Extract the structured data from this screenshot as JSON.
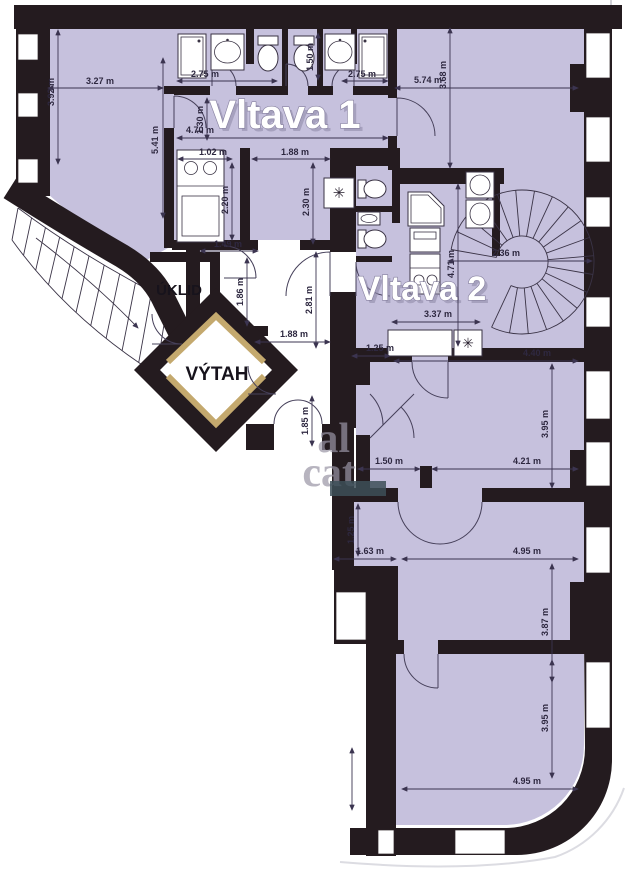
{
  "plan": {
    "type": "apartment-floor-plan",
    "units": "m",
    "rooms": {
      "vltava1": "Vltava 1",
      "vltava2": "Vltava 2",
      "uklid": "ÚKLID",
      "vytah": "VÝTAH"
    },
    "watermark": {
      "fragment1": "al",
      "fragment2": "cat"
    },
    "colors": {
      "wall": "#241b1f",
      "apartment_fill": "#c6c1dd",
      "common_fill": "#ffffff",
      "elevator_frame": "#c4a96e",
      "dimension_text": "#2e2840"
    },
    "fixtures": [
      "shower",
      "washbasin",
      "toilet",
      "toilet",
      "washbasin",
      "shower",
      "kitchen-sink-unit",
      "washing-machine",
      "toilet",
      "washbasin",
      "toilet",
      "corner-shower",
      "washbasin",
      "bathtub",
      "refrigerator",
      "stove",
      "kitchen-counter",
      "dishwasher",
      "spiral-staircase",
      "main-staircase",
      "elevator"
    ],
    "dimensions": [
      {
        "label": "3.92 m",
        "tx": 54,
        "ty": 92,
        "rot": -90,
        "arrow": [
          58,
          30,
          58,
          164
        ]
      },
      {
        "label": "3.27 m",
        "tx": 100,
        "ty": 84,
        "rot": 0,
        "arrow": [
          48,
          88,
          163,
          88
        ]
      },
      {
        "label": "5.41 m",
        "tx": 158,
        "ty": 140,
        "rot": -90,
        "arrow": [
          163,
          58,
          163,
          218
        ]
      },
      {
        "label": "2.75 m",
        "tx": 205,
        "ty": 77,
        "rot": 0,
        "arrow": [
          177,
          81,
          277,
          81
        ]
      },
      {
        "label": "1.50 m",
        "tx": 313,
        "ty": 57,
        "rot": -90,
        "arrow": [
          318,
          33,
          318,
          80
        ]
      },
      {
        "label": "2.75 m",
        "tx": 362,
        "ty": 77,
        "rot": 0,
        "arrow": [
          342,
          81,
          388,
          81
        ]
      },
      {
        "label": "4.70 m",
        "tx": 200,
        "ty": 133,
        "rot": 0,
        "arrow": [
          177,
          138,
          388,
          138
        ]
      },
      {
        "label": "1.30 m",
        "tx": 203,
        "ty": 120,
        "rot": -90,
        "arrow": [
          207,
          98,
          207,
          140
        ]
      },
      {
        "label": "1.02 m",
        "tx": 213,
        "ty": 155,
        "rot": 0,
        "arrow": [
          178,
          159,
          232,
          159
        ]
      },
      {
        "label": "1.88 m",
        "tx": 295,
        "ty": 155,
        "rot": 0,
        "arrow": [
          252,
          159,
          330,
          159
        ]
      },
      {
        "label": "2.20 m",
        "tx": 228,
        "ty": 200,
        "rot": -90,
        "arrow": [
          232,
          163,
          232,
          240
        ]
      },
      {
        "label": "2.30 m",
        "tx": 309,
        "ty": 202,
        "rot": -90,
        "arrow": [
          313,
          163,
          313,
          244
        ]
      },
      {
        "label": "5.74 m",
        "tx": 428,
        "ty": 83,
        "rot": 0,
        "arrow": [
          395,
          88,
          578,
          88
        ]
      },
      {
        "label": "3.68 m",
        "tx": 446,
        "ty": 75,
        "rot": -90,
        "arrow": [
          450,
          28,
          450,
          168
        ]
      },
      {
        "label": "1.49 m",
        "tx": 228,
        "ty": 247,
        "rot": 0,
        "arrow": [
          200,
          251,
          258,
          251
        ]
      },
      {
        "label": "1.86 m",
        "tx": 243,
        "ty": 292,
        "rot": -90,
        "arrow": [
          247,
          258,
          247,
          326
        ]
      },
      {
        "label": "2.81 m",
        "tx": 312,
        "ty": 300,
        "rot": -90,
        "arrow": [
          316,
          252,
          316,
          348
        ]
      },
      {
        "label": "1.88 m",
        "tx": 294,
        "ty": 337,
        "rot": 0,
        "arrow": [
          255,
          342,
          330,
          342
        ]
      },
      {
        "label": "1.85 m",
        "tx": 308,
        "ty": 421,
        "rot": -90,
        "arrow": [
          312,
          396,
          312,
          446
        ]
      },
      {
        "label": "4.71 m",
        "tx": 454,
        "ty": 264,
        "rot": -90,
        "arrow": [
          458,
          184,
          458,
          346
        ]
      },
      {
        "label": "2.36 m",
        "tx": 506,
        "ty": 256,
        "rot": 0,
        "arrow": [
          448,
          261,
          592,
          261
        ]
      },
      {
        "label": "3.37 m",
        "tx": 438,
        "ty": 317,
        "rot": 0,
        "arrow": [
          392,
          322,
          480,
          322
        ]
      },
      {
        "label": "1.25 m",
        "tx": 380,
        "ty": 351,
        "rot": 0,
        "arrow": [
          352,
          356,
          390,
          356
        ]
      },
      {
        "label": "4.40 m",
        "tx": 537,
        "ty": 356,
        "rot": 0,
        "arrow": [
          394,
          361,
          578,
          361
        ]
      },
      {
        "label": "3.95 m",
        "tx": 548,
        "ty": 424,
        "rot": -90,
        "arrow": [
          552,
          364,
          552,
          488
        ]
      },
      {
        "label": "1.50 m",
        "tx": 389,
        "ty": 464,
        "rot": 0,
        "arrow": [
          358,
          469,
          420,
          469
        ]
      },
      {
        "label": "4.21 m",
        "tx": 527,
        "ty": 464,
        "rot": 0,
        "arrow": [
          432,
          469,
          578,
          469
        ]
      },
      {
        "label": "1.25 m",
        "tx": 354,
        "ty": 530,
        "rot": -90,
        "arrow": [
          358,
          504,
          358,
          556
        ]
      },
      {
        "label": "1.63 m",
        "tx": 370,
        "ty": 554,
        "rot": 0,
        "arrow": [
          334,
          559,
          396,
          559
        ]
      },
      {
        "label": "4.95 m",
        "tx": 527,
        "ty": 554,
        "rot": 0,
        "arrow": [
          402,
          559,
          578,
          559
        ]
      },
      {
        "label": "3.87 m",
        "tx": 548,
        "ty": 622,
        "rot": -90,
        "arrow": [
          552,
          564,
          552,
          682
        ]
      },
      {
        "label": "3.95 m",
        "tx": 548,
        "ty": 718,
        "rot": -90,
        "arrow": [
          552,
          660,
          552,
          778
        ]
      },
      {
        "label": "4.95 m",
        "tx": 527,
        "ty": 784,
        "rot": 0,
        "arrow": [
          402,
          789,
          578,
          789
        ]
      },
      {
        "label": "",
        "tx": 0,
        "ty": 0,
        "rot": 0,
        "arrow": [
          352,
          748,
          352,
          810
        ]
      }
    ]
  }
}
